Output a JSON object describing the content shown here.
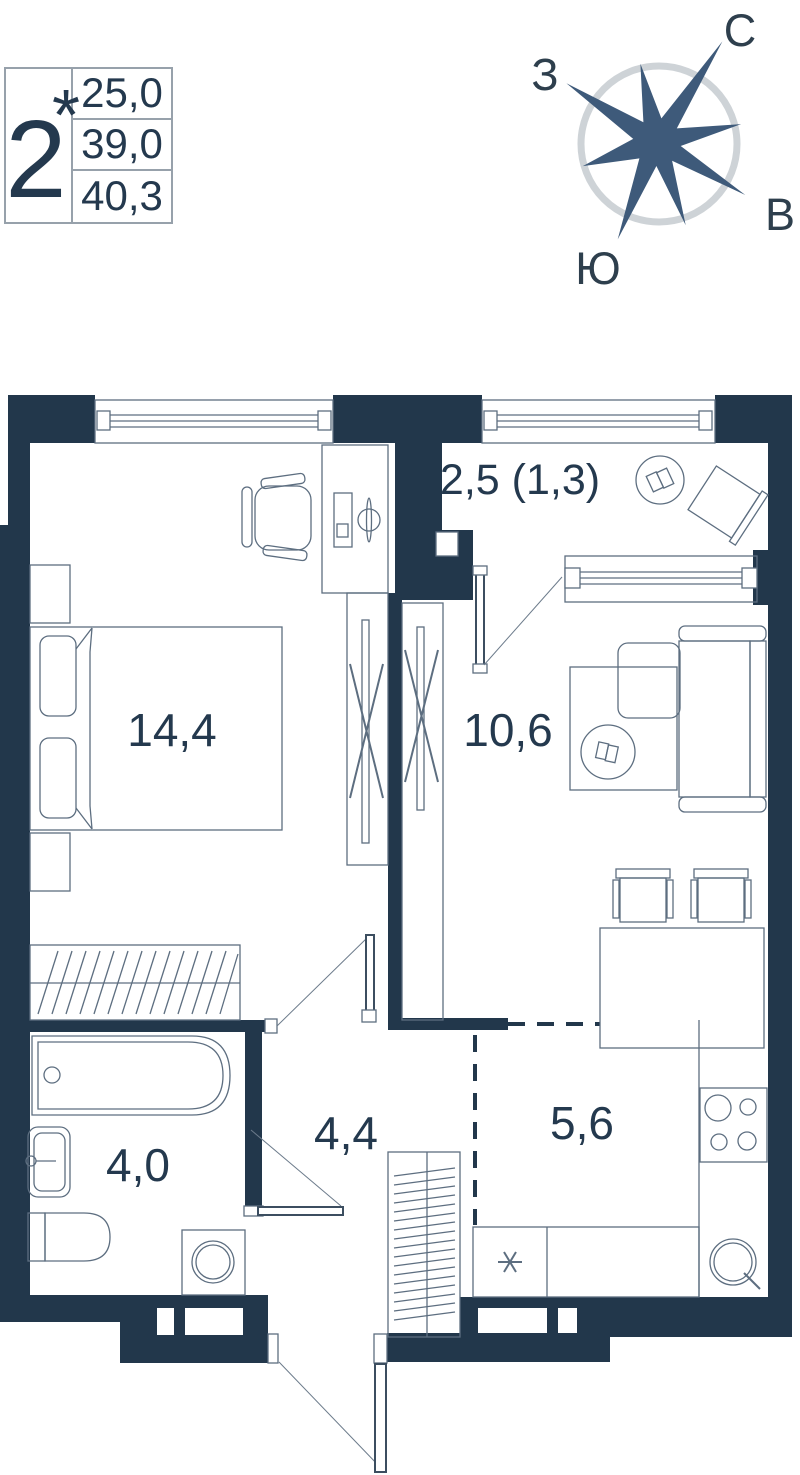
{
  "info_box": {
    "room_count": "2",
    "star": "*",
    "areas": [
      "25,0",
      "39,0",
      "40,3"
    ]
  },
  "compass": {
    "north": "С",
    "west": "З",
    "east": "В",
    "south": "Ю"
  },
  "rooms": {
    "bedroom": {
      "area": "14,4"
    },
    "balcony": {
      "area": "2,5 (1,3)"
    },
    "living": {
      "area": "10,6"
    },
    "hall": {
      "area": "4,4"
    },
    "bathroom": {
      "area": "4,0"
    },
    "kitchen": {
      "area": "5,6"
    }
  },
  "icons": {
    "kitchen_spot_marker": "asterisk",
    "compass_star": "eight-point-star"
  },
  "colors": {
    "wall": "#22374b",
    "furniture_line": "#5d6e80",
    "label_text": "#24394e",
    "compass_star": "#3e5a7a",
    "compass_ring": "#ced3d7"
  }
}
